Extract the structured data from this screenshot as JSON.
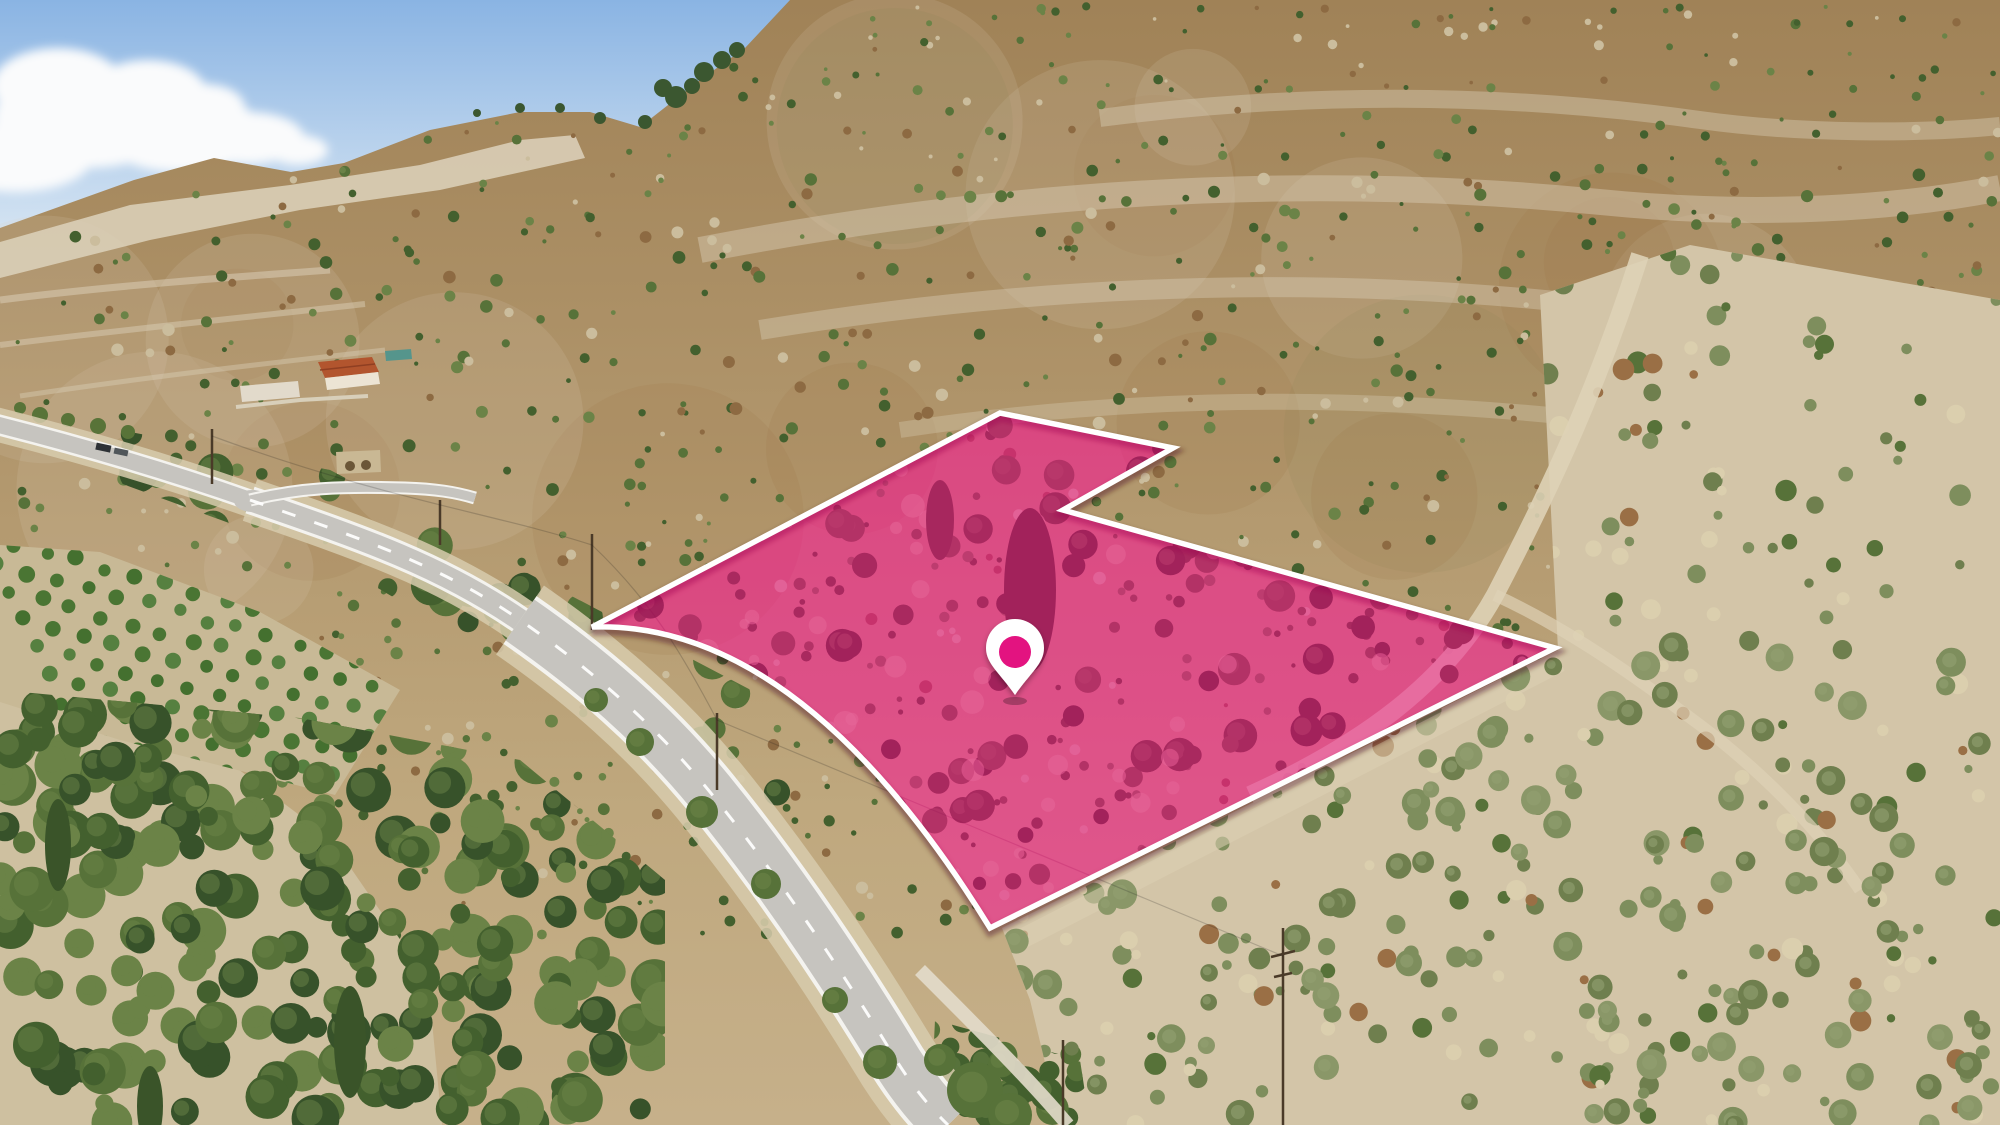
{
  "scene": {
    "kind": "aerial-drone-photo-with-land-plot-overlay",
    "width": 2000,
    "height": 1125
  },
  "plot": {
    "path_d": "M 592 627 L 1000 413 L 1173 448 L 1063 510 L 1555 648 L 990 928 Q 800 620 592 627 Z",
    "fill": "#d81478",
    "fill_opacity": "0.48",
    "blend_fill": "#ff2e9a",
    "blend_opacity": "0.38",
    "outline_color": "#ffffff",
    "outline_width": "5.5"
  },
  "marker": {
    "body_d": "M 1015 695 C 1000 673 986 664 986 648 A 29 29 0 1 1 1044 648 C 1044 664 1030 673 1015 695 Z",
    "body_color": "#ffffff",
    "dot_cx": "1015",
    "dot_cy": "652",
    "dot_r": "16",
    "dot_color": "#e31380"
  },
  "palette": {
    "sky_top": "#8ab4e3",
    "sky_bottom": "#d8e6f3",
    "cloud": "#fafbfc",
    "hill_top": "#a08257",
    "hill_bottom": "#c6b08a",
    "chalk": "#ddd2bc",
    "scrub_dark": "#43602e",
    "scrub_deep": "#37522a",
    "scrub_mid": "#577239",
    "scrub_light": "#6b8347",
    "sage": "#7e8e5d",
    "russet": "#9a6f45",
    "pale_dot": "#cbbd9d",
    "dry_grass": "#dbcfae",
    "cream": "#d3c5a8",
    "dry_field": "#cec0a0",
    "orchard_base": "#c8b996",
    "orchard_green": "#44702f",
    "road_asphalt": "#c6c4bf",
    "road_marking": "#f4f3ef",
    "road_verge": "#d7cbad",
    "wall": "#e3dccb",
    "cypress": "#3a5429",
    "pine": "#3b5730",
    "pole_brown": "#4a3a28",
    "roof_red": "#b2552e",
    "building_white": "#ece4d4",
    "pool_teal": "#55958c"
  }
}
